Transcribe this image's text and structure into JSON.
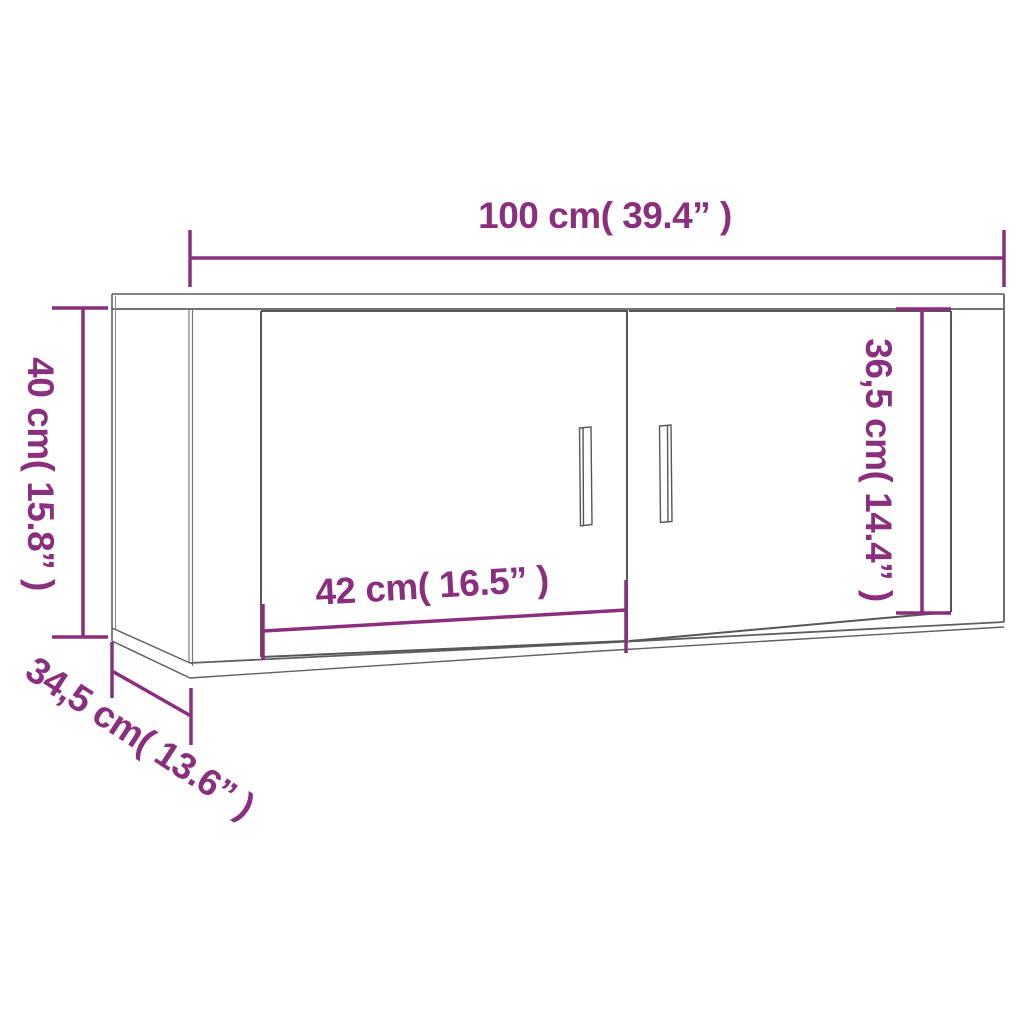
{
  "diagram": {
    "type": "product-dimension-diagram",
    "subject": "wall-mounted two-door cabinet",
    "colors": {
      "dimension_accent": "#8a2f7e",
      "outline_gray": "#5f5f5f",
      "background": "#ffffff"
    },
    "dimensions": {
      "width": {
        "label": "100 cm( 39.4” )"
      },
      "height": {
        "label": "40 cm( 15.8” )"
      },
      "door_height": {
        "label": "36,5 cm( 14.4” )"
      },
      "door_width": {
        "label": "42 cm( 16.5” )"
      },
      "depth": {
        "label": "34,5 cm( 13.6” )"
      }
    }
  }
}
